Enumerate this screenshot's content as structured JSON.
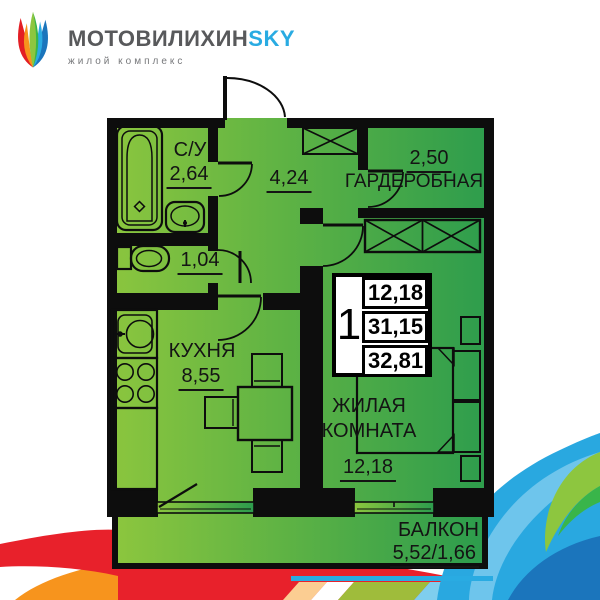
{
  "logo": {
    "brand_main": "МОТОВИЛИХИН",
    "brand_accent": "SKY",
    "subtitle": "жилой комплекс"
  },
  "floorplan": {
    "rooms": {
      "bathroom": {
        "label": "С/У",
        "area": "2,64"
      },
      "hallway": {
        "area": "4,24"
      },
      "wardrobe": {
        "label": "ГАРДЕРОБНАЯ",
        "area": "2,50"
      },
      "toilet": {
        "area": "1,04"
      },
      "kitchen": {
        "label": "КУХНЯ",
        "area": "8,55"
      },
      "living_room": {
        "label": "ЖИЛАЯ КОМНАТА",
        "area": "12,18"
      },
      "balcony": {
        "label": "БАЛКОН",
        "area": "5,52/1,66"
      }
    },
    "info_box": {
      "rooms_count": "1",
      "living_area": "12,18",
      "area_without_balcony": "31,15",
      "total_area": "32,81"
    }
  },
  "colors": {
    "floor_green_light": "#8dc63f",
    "floor_green_dark": "#2e9e4f",
    "walls": "#0d0d0d",
    "brand_blue": "#29abe2",
    "brand_gray": "#58595b",
    "decor_red": "#e8212b",
    "decor_orange": "#f7941d",
    "decor_blue_dark": "#1b75bc",
    "decor_green": "#8dc63f"
  }
}
